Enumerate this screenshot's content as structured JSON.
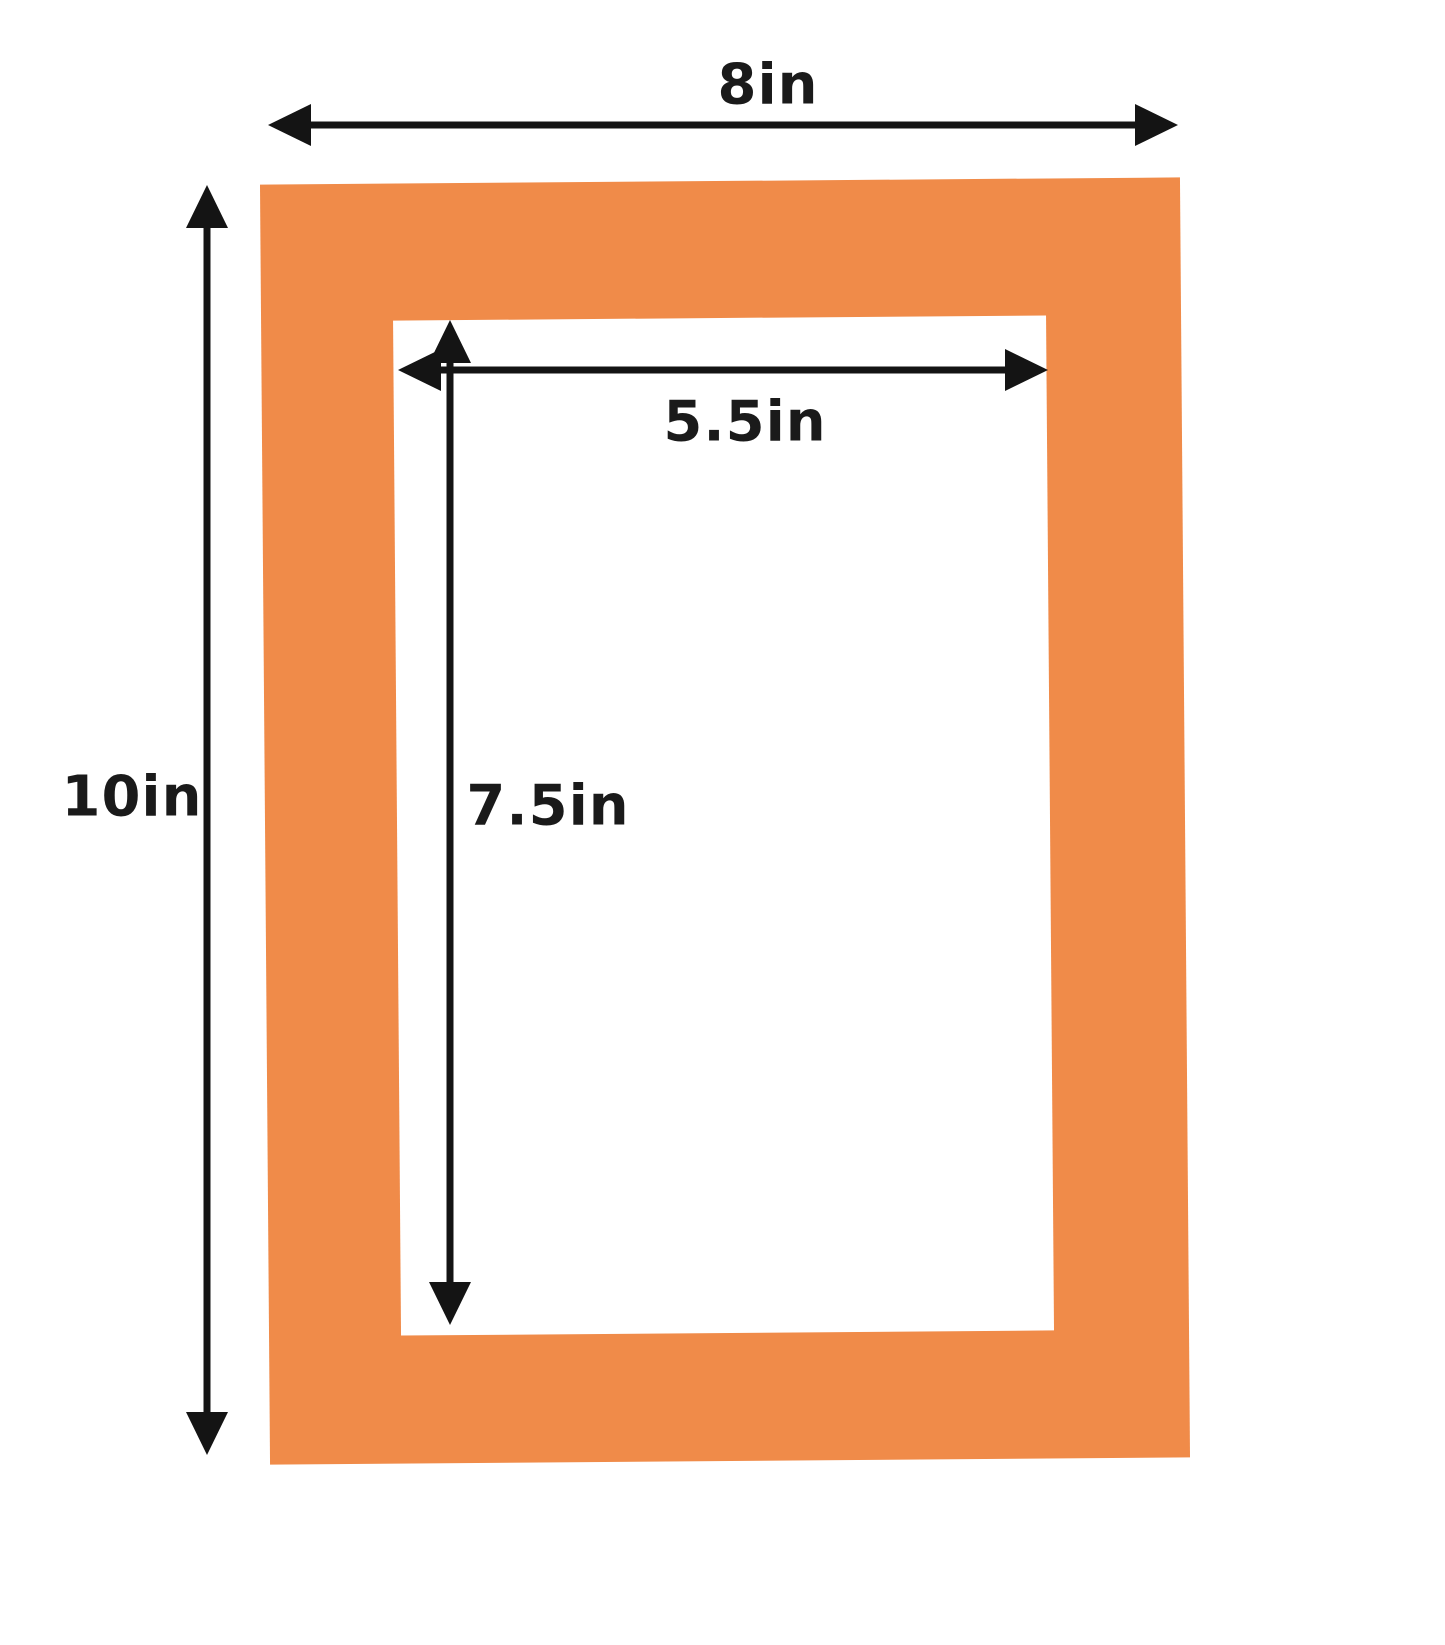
{
  "diagram": {
    "colors": {
      "mat": "#F08B49",
      "opening": "#FFFFFF",
      "background": "#FFFFFF",
      "arrow": "#141414",
      "label_text": "#1A1A1A"
    },
    "labels": {
      "outer_width": "8in",
      "outer_height": "10in",
      "opening_width": "5.5in",
      "opening_height": "7.5in"
    }
  }
}
